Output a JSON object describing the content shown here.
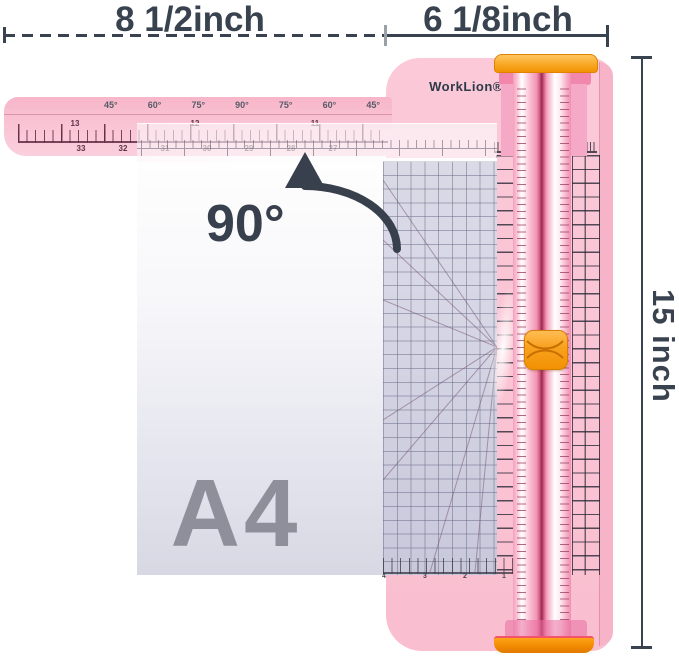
{
  "dimensions": {
    "top_left": "8 1/2inch",
    "top_right": "6 1/8inch",
    "right": "15 inch"
  },
  "annotations": {
    "rotation": "90°",
    "paper_size": "A4"
  },
  "brand": "WorkLion®",
  "swing_arm": {
    "angle_labels": [
      "45°",
      "60°",
      "75°",
      "90°",
      "75°",
      "60°",
      "45°"
    ],
    "inch_numbers": [
      "13",
      "12",
      "11"
    ],
    "cm_numbers": [
      "33",
      "32",
      "31",
      "30",
      "29",
      "28",
      "27"
    ]
  },
  "grid_plate": {
    "bottom_scale_numbers": [
      "4",
      "3",
      "2",
      "1"
    ]
  },
  "colors": {
    "annotation_dark": "#39424f",
    "base_pink": "#fac6d5",
    "rail_pink": "#f59fbe",
    "accent_orange": "#f49b1b",
    "paper_lavender": "#dadae6",
    "a4_gray": "#8f8f9c"
  }
}
